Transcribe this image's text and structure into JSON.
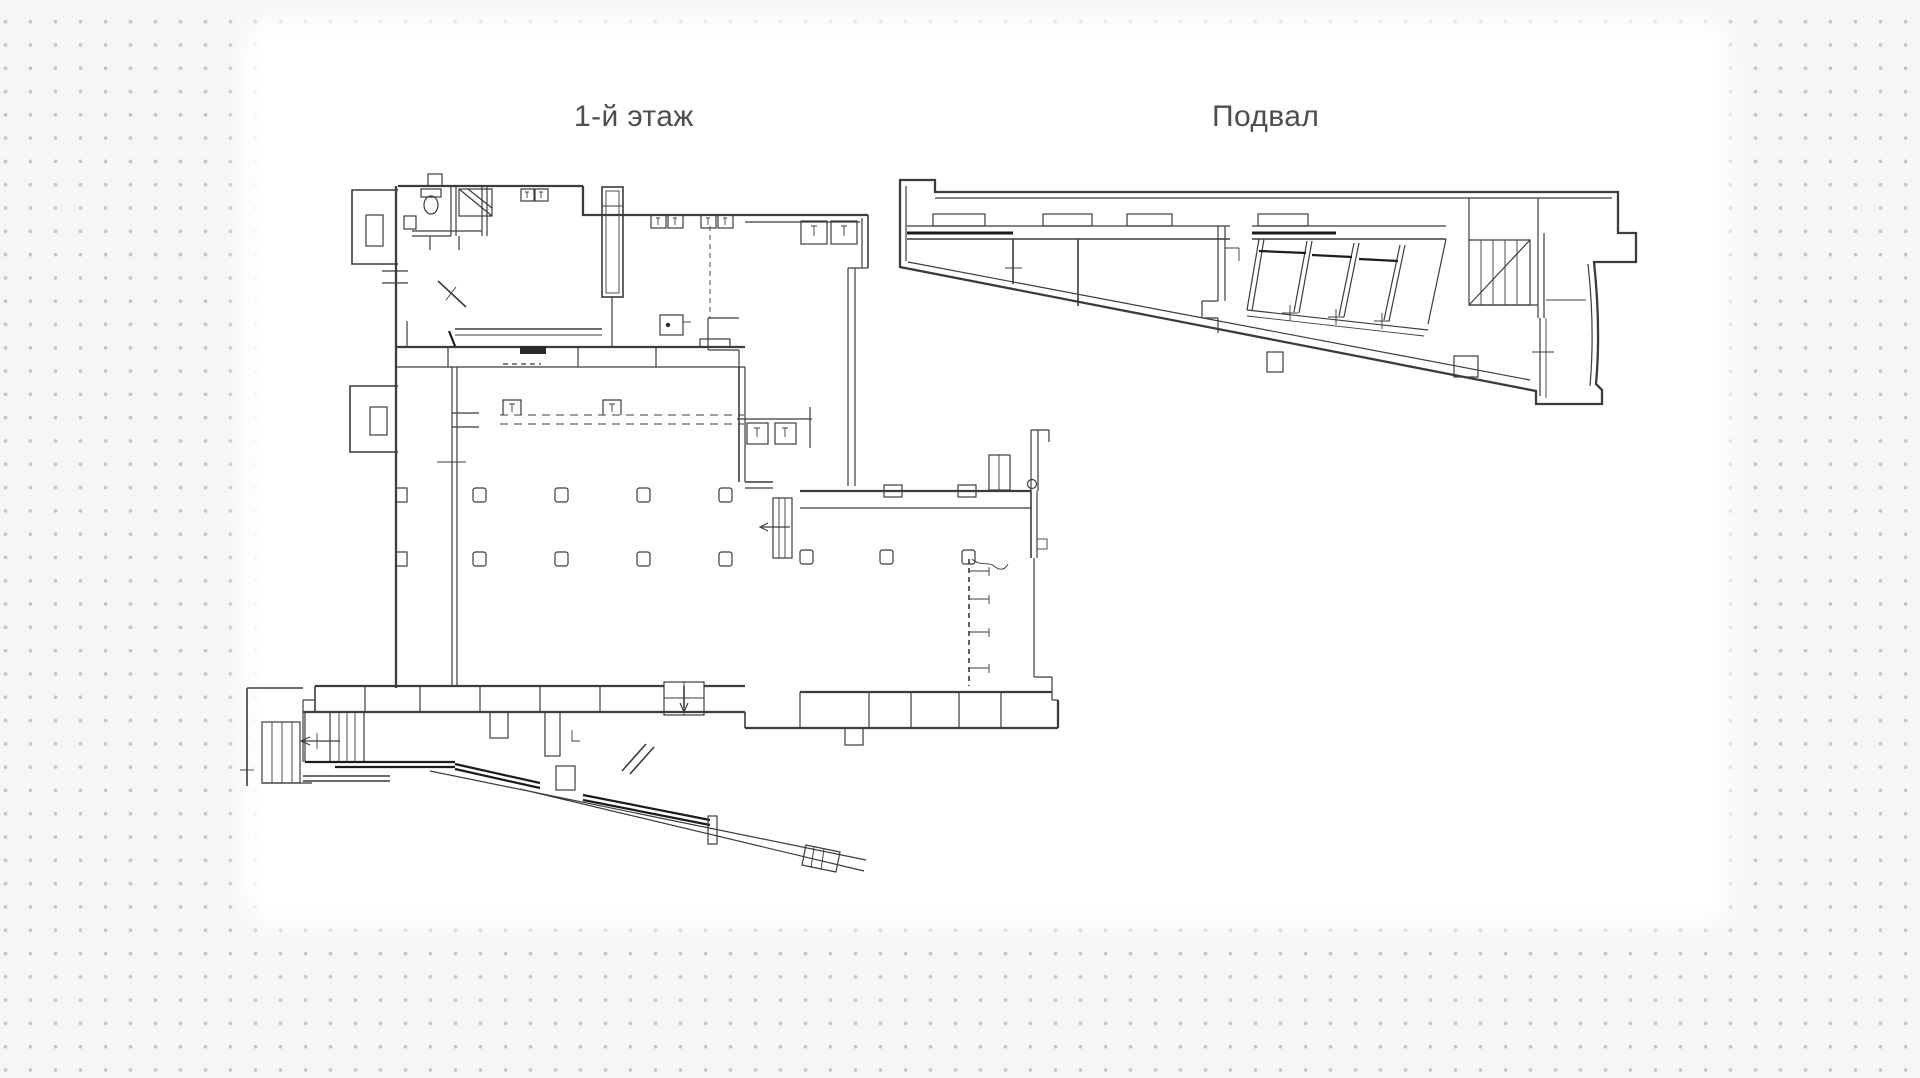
{
  "canvas": {
    "width": 1920,
    "height": 1078
  },
  "background": {
    "page_color": "#f7f6f4",
    "dot_color": "#c8c6c4",
    "paper_color": "#ffffff"
  },
  "drawing": {
    "line_color": "#3c3c3c",
    "dark_line_color": "#1c1c1c"
  },
  "plans": [
    {
      "id": "first-floor",
      "title": "1-й этаж"
    },
    {
      "id": "basement",
      "title": "Подвал"
    }
  ]
}
